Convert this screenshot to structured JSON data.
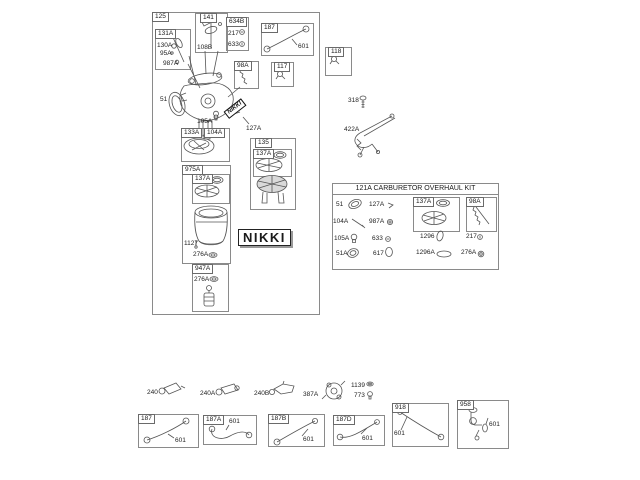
{
  "colors": {
    "line": "#555555",
    "text": "#1a1a1a",
    "bg": "#ffffff",
    "dark_part": "#bdbdbd"
  },
  "brand": {
    "sticker": "NIKKI",
    "logo": "NIKKI"
  },
  "main": {
    "label": "125",
    "groups": {
      "g131A": {
        "label": "131A",
        "p130A": "130A",
        "p95A": "95A",
        "p987A": "987A"
      },
      "g141": {
        "label": "141",
        "p108B": "108B"
      },
      "g634B": {
        "label": "634B",
        "p217": "217",
        "p633": "633"
      },
      "g187": {
        "label": "187",
        "p601": "601"
      },
      "g98A": {
        "label": "98A"
      },
      "g117": {
        "label": "117"
      },
      "g133A": {
        "label": "133A",
        "p104A": "104A"
      },
      "g135": {
        "label": "135",
        "g137A": "137A"
      },
      "g975A": {
        "label": "975A",
        "g137A": "137A",
        "p1127": "1127",
        "p276A": "276A"
      },
      "g947A": {
        "label": "947A",
        "p276A": "276A"
      }
    },
    "callouts": {
      "p51": "51",
      "p105A": "105A",
      "p127A": "127A"
    }
  },
  "right": {
    "g118": {
      "label": "118"
    },
    "p318": "318",
    "p422A": "422A"
  },
  "kit": {
    "title": "121A CARBURETOR OVERHAUL KIT",
    "items": {
      "p51": "51",
      "p127A": "127A",
      "p104A": "104A",
      "p987A": "987A",
      "p105A": "105A",
      "p633": "633",
      "p51A": "51A",
      "p617": "617",
      "p1296": "1296",
      "p217": "217",
      "p1296A": "1296A",
      "p276A": "276A"
    },
    "boxes": {
      "g137A": "137A",
      "g98A": "98A"
    }
  },
  "bottom": {
    "loose": {
      "p240": "240",
      "p240A": "240A",
      "p240B": "240B",
      "p387A": "387A",
      "p1139": "1139",
      "p773": "773"
    },
    "hoses": {
      "g187": {
        "label": "187",
        "p601": "601"
      },
      "g187A": {
        "label": "187A",
        "p601": "601"
      },
      "g187B": {
        "label": "187B",
        "p601": "601"
      },
      "g187D": {
        "label": "187D",
        "p601": "601"
      },
      "g918": {
        "label": "918",
        "p601": "601"
      },
      "g958": {
        "label": "958",
        "p601": "601"
      }
    }
  }
}
